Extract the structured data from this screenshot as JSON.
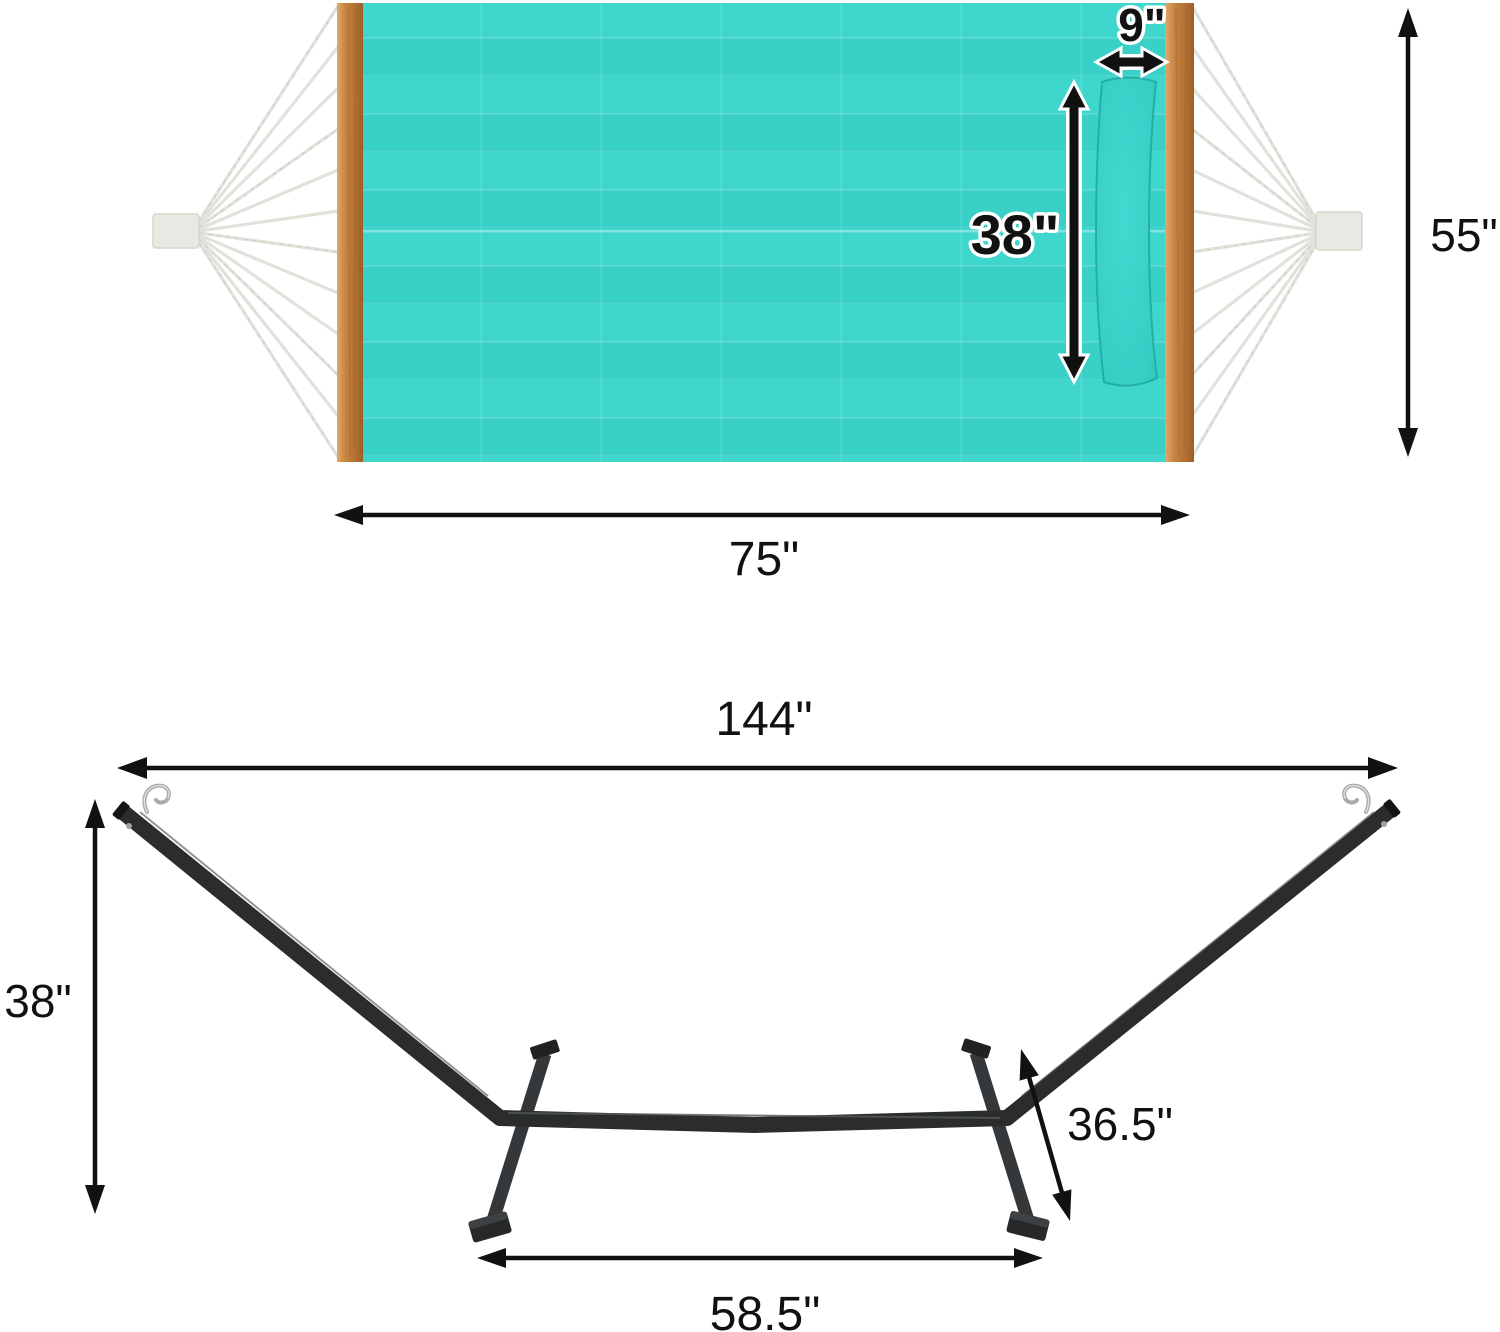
{
  "image": {
    "type": "product-dimension-diagram",
    "product": "quilted hammock with spreader bars, pillow and steel stand"
  },
  "hammock_top_view": {
    "pillow_width_label": "9\"",
    "pillow_length_label": "38\"",
    "hammock_width_label": "55\"",
    "bed_length_label": "75\""
  },
  "stand_side_view": {
    "stand_length_label": "144\"",
    "stand_height_label": "38\"",
    "leg_length_label": "36.5\"",
    "base_span_label": "58.5\""
  },
  "colors": {
    "fabric": "#3CD3CA",
    "pillow": "#35CCC4",
    "wood": "#C0803F",
    "rope": "#E1E1DA",
    "stand_steel": "#2B2D2E",
    "dimension_lines": "#111111",
    "background": "#FFFFFF"
  }
}
